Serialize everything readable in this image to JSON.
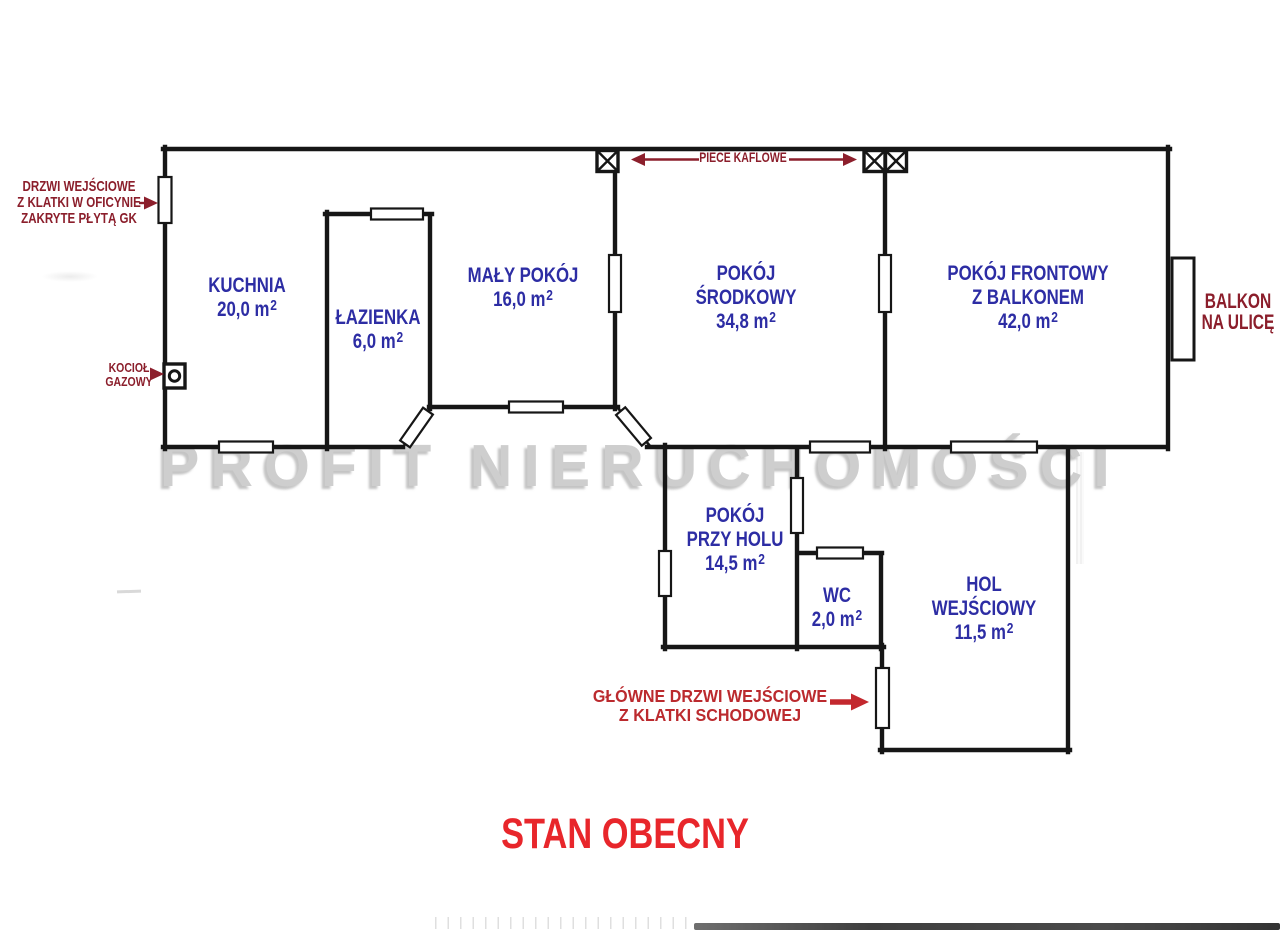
{
  "watermark": "PROFIT NIERUCHOMOŚCI",
  "title": "STAN OBECNY",
  "sup2": "2",
  "rooms": {
    "kuchnia": {
      "name1": "KUCHNIA",
      "area": "20,0 m"
    },
    "lazienka": {
      "name1": "ŁAZIENKA",
      "area": "6,0 m"
    },
    "maly_pokoj": {
      "name1": "MAŁY POKÓJ",
      "area": "16,0 m"
    },
    "pokoj_srodkowy": {
      "name1": "POKÓJ",
      "name2": "ŚRODKOWY",
      "area": "34,8 m"
    },
    "pokoj_frontowy": {
      "name1": "POKÓJ FRONTOWY",
      "name2": "Z BALKONEM",
      "area": "42,0 m"
    },
    "pokoj_przy_holu": {
      "name1": "POKÓJ",
      "name2": "PRZY HOLU",
      "area": "14,5 m"
    },
    "wc": {
      "name1": "WC",
      "area": "2,0 m"
    },
    "hol_wejsciowy": {
      "name1": "HOL",
      "name2": "WEJŚCIOWY",
      "area": "11,5 m"
    }
  },
  "annotations": {
    "side_door": {
      "line1": "DRZWI WEJŚCIOWE",
      "line2": "Z KLATKI W OFICYNIE",
      "line3": "ZAKRYTE PŁYTĄ GK"
    },
    "boiler": {
      "line1": "KOCIOŁ",
      "line2": "GAZOWY"
    },
    "stoves": {
      "label": "PIECE KAFLOWE"
    },
    "balcony": {
      "line1": "BALKON",
      "line2": "NA ULICĘ"
    },
    "main_door": {
      "line1": "GŁÓWNE DRZWI WEJŚCIOWE",
      "line2": "Z KLATKI SCHODOWEJ"
    }
  },
  "colors": {
    "room_label": "#2d2da4",
    "annotation": "#8b1e2b",
    "main_door_text": "#bb2a2e",
    "title": "#e8262b",
    "watermark": "#cecece",
    "walls": "#161616"
  }
}
